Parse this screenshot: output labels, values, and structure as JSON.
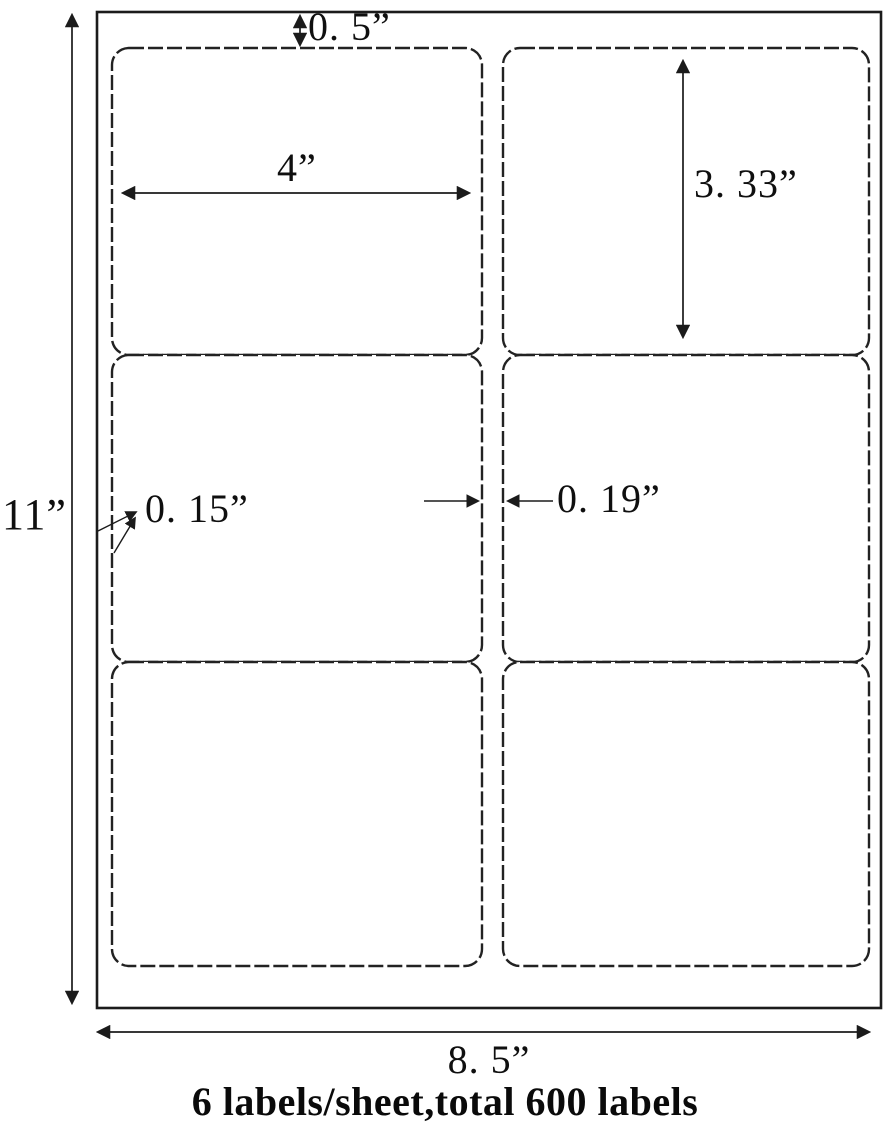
{
  "sheet_diagram": {
    "grid": {
      "rows": 3,
      "columns": 2
    },
    "dimensions": {
      "top_margin": "0. 5”",
      "label_width": "4”",
      "label_height": "3. 33”",
      "side_margin": "0. 15”",
      "center_gap": "0. 19”",
      "sheet_height": "11”",
      "sheet_width": "8. 5”"
    },
    "caption": "6 labels/sheet,total 600 labels",
    "colors": {
      "background": "#ffffff",
      "outline": "#1b1b1b",
      "text": "#0f0f0f"
    }
  }
}
